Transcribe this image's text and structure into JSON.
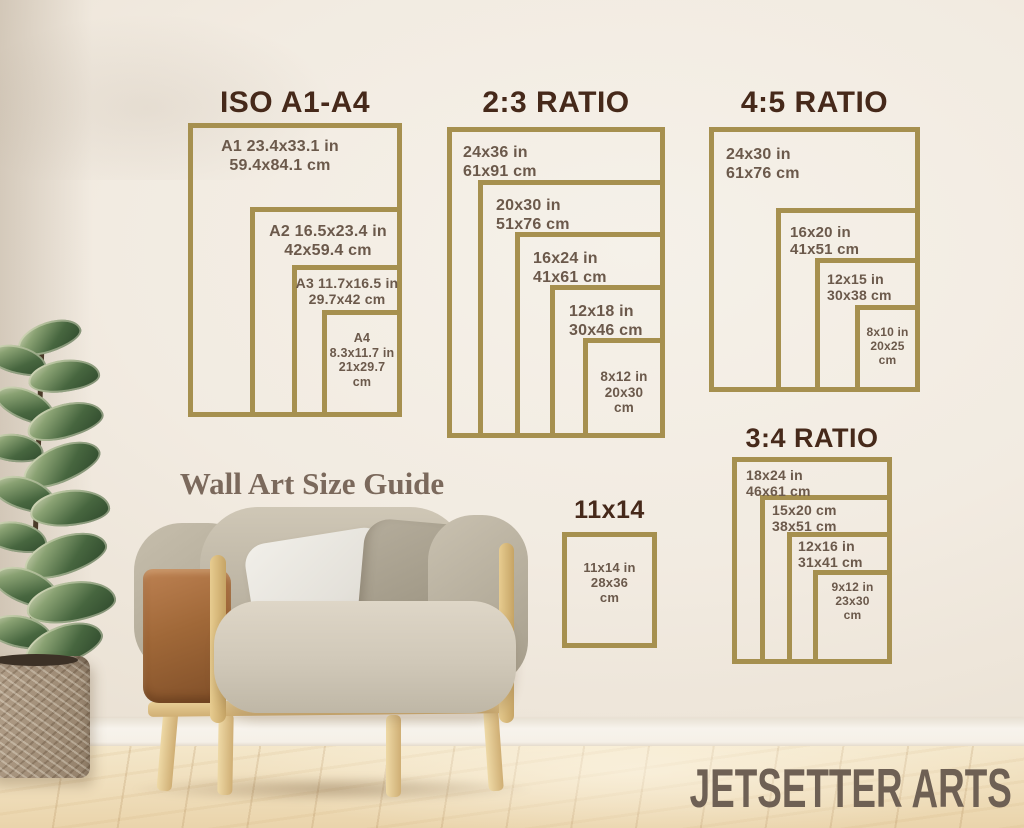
{
  "heading": "Wall Art Size Guide",
  "brand": "JETSETTER ARTS",
  "colors": {
    "frame_gold": "#a6904f",
    "chart_title": "#46291a",
    "size_label": "#6b594b",
    "heading_text": "#7b695c",
    "brand_text": "#6e6054"
  },
  "charts": [
    {
      "title": "ISO A1-A4",
      "frames": [
        {
          "name": "A1",
          "lines": [
            "A1 23.4x33.1 in",
            "59.4x84.1 cm"
          ]
        },
        {
          "name": "A2",
          "lines": [
            "A2 16.5x23.4 in",
            "42x59.4 cm"
          ]
        },
        {
          "name": "A3",
          "lines": [
            "A3 11.7x16.5 in",
            "29.7x42 cm"
          ]
        },
        {
          "name": "A4",
          "lines": [
            "A4",
            "8.3x11.7 in",
            "21x29.7",
            "cm"
          ]
        }
      ]
    },
    {
      "title": "2:3 RATIO",
      "frames": [
        {
          "name": "24x36",
          "lines": [
            "24x36 in",
            "61x91 cm"
          ]
        },
        {
          "name": "20x30",
          "lines": [
            "20x30 in",
            "51x76 cm"
          ]
        },
        {
          "name": "16x24",
          "lines": [
            "16x24 in",
            "41x61 cm"
          ]
        },
        {
          "name": "12x18",
          "lines": [
            "12x18 in",
            "30x46 cm"
          ]
        },
        {
          "name": "8x12",
          "lines": [
            "8x12 in",
            "20x30",
            "cm"
          ]
        }
      ]
    },
    {
      "title": "4:5 RATIO",
      "frames": [
        {
          "name": "24x30",
          "lines": [
            "24x30 in",
            "61x76 cm"
          ]
        },
        {
          "name": "16x20",
          "lines": [
            "16x20 in",
            "41x51 cm"
          ]
        },
        {
          "name": "12x15",
          "lines": [
            "12x15 in",
            "30x38 cm"
          ]
        },
        {
          "name": "8x10",
          "lines": [
            "8x10 in",
            "20x25",
            "cm"
          ]
        }
      ]
    },
    {
      "title": "3:4 RATIO",
      "frames": [
        {
          "name": "18x24",
          "lines": [
            "18x24 in",
            "46x61 cm"
          ]
        },
        {
          "name": "15x20",
          "lines": [
            "15x20 cm",
            "38x51 cm"
          ]
        },
        {
          "name": "12x16",
          "lines": [
            "12x16 in",
            "31x41 cm"
          ]
        },
        {
          "name": "9x12",
          "lines": [
            "9x12 in",
            "23x30",
            "cm"
          ]
        }
      ]
    },
    {
      "title": "11x14",
      "frames": [
        {
          "name": "11x14",
          "lines": [
            "11x14 in",
            "28x36",
            "cm"
          ]
        }
      ]
    }
  ]
}
